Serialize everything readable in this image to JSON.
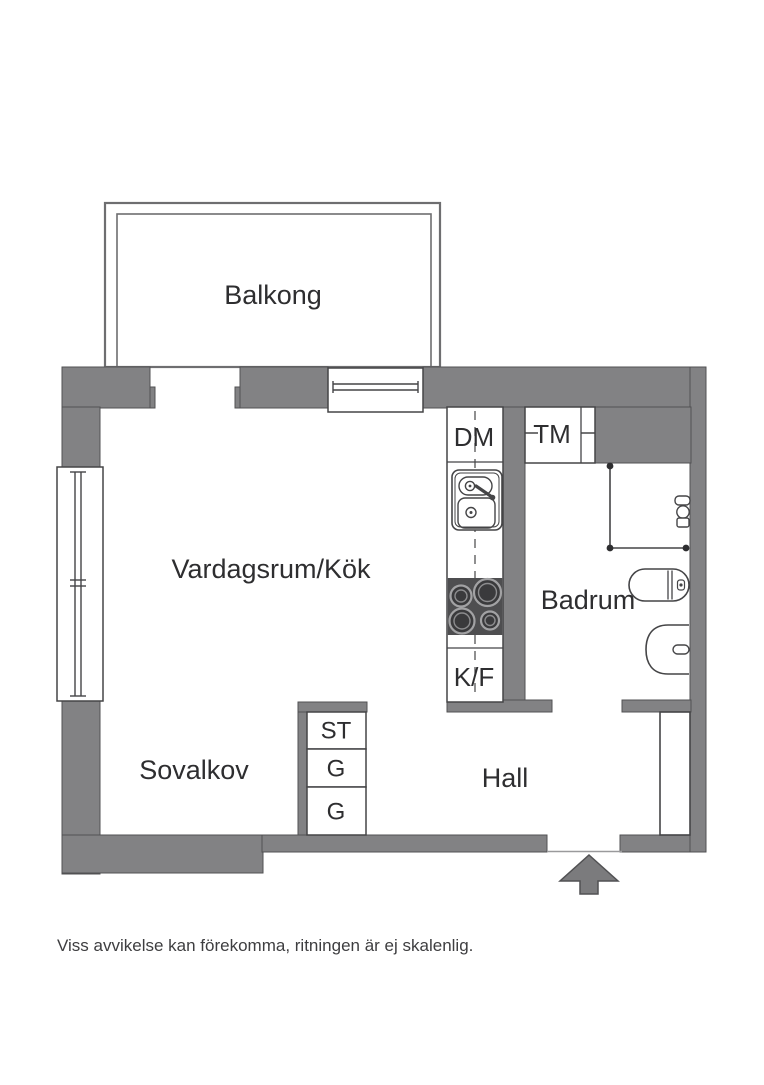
{
  "rooms": {
    "balcony": "Balkong",
    "living_kitchen": "Vardagsrum/Kök",
    "sleeping_alcove": "Sovalkov",
    "hall": "Hall",
    "bathroom": "Badrum"
  },
  "fixtures": {
    "dishwasher": "DM",
    "washing_machine": "TM",
    "fridge_freezer": "K/F",
    "cleaning_closet": "ST",
    "wardrobe_top": "G",
    "wardrobe_bottom": "G"
  },
  "footer": {
    "disclaimer": "Viss avvikelse kan förekomma, ritningen är ej skalenlig."
  },
  "colors": {
    "wall": "#828284",
    "outline": "#515153",
    "stove": "#4e4e50",
    "burner": "#3a3a3c",
    "burner_ring": "#a2a2a4",
    "line": "#454547",
    "text": "#2e2e30",
    "rail": "#6e6e70",
    "background": "#ffffff"
  }
}
